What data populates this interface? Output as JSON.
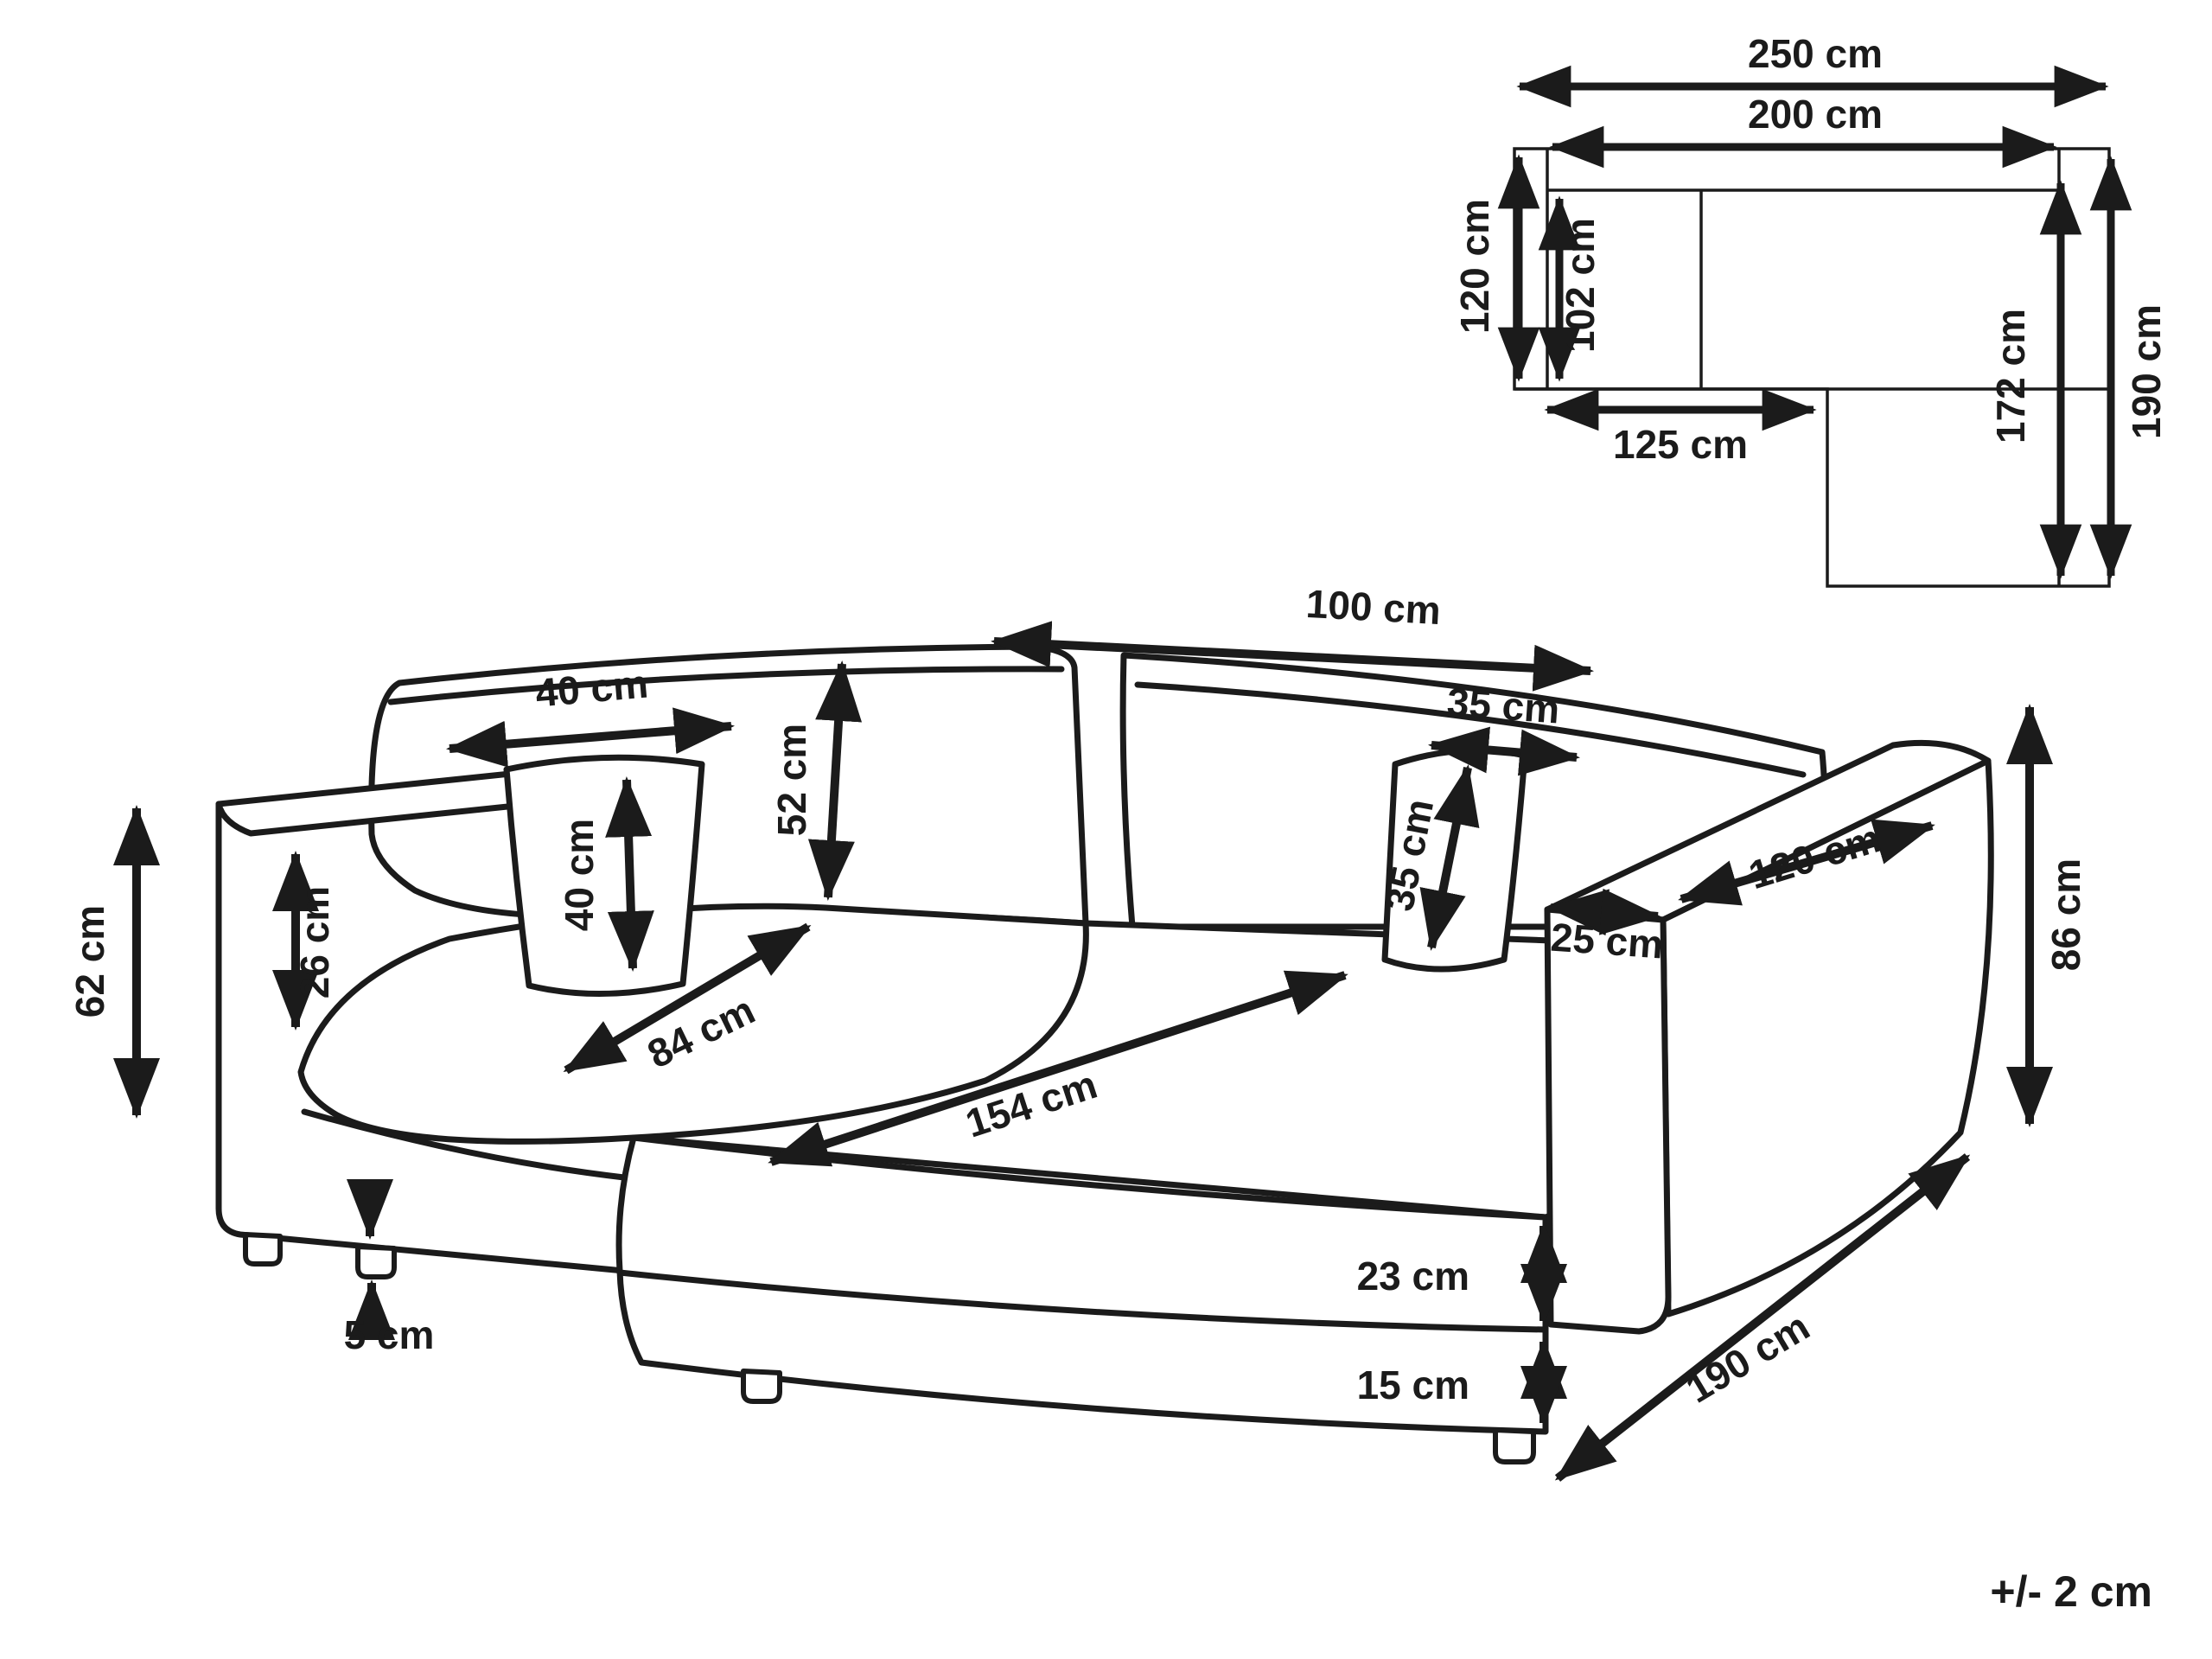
{
  "plan": {
    "overall_width": "250 cm",
    "body_width": "200 cm",
    "left_depth": "120 cm",
    "left_seat_depth": "102 cm",
    "left_section_width": "125 cm",
    "chaise_inner_length": "172 cm",
    "chaise_length": "190 cm"
  },
  "main": {
    "armrest_height": "62 cm",
    "armrest_above_seat": "26 cm",
    "pillow_left_width": "40 cm",
    "pillow_left_height": "40 cm",
    "backrest_height": "52 cm",
    "seat_depth": "84 cm",
    "backrest_width": "100 cm",
    "pillow_right_width": "35 cm",
    "pillow_right_height": "35 cm",
    "armrest_front_width": "25 cm",
    "armrest_length": "120 cm",
    "overall_height": "86 cm",
    "chaise_seat_length": "154 cm",
    "seat_cushion_height": "23 cm",
    "base_height": "15 cm",
    "leg_height": "5 cm",
    "chaise_total_length": "190 cm"
  },
  "note": {
    "tolerance": "+/- 2 cm"
  },
  "colors": {
    "line": "#1b1b1b",
    "background": "#ffffff"
  }
}
